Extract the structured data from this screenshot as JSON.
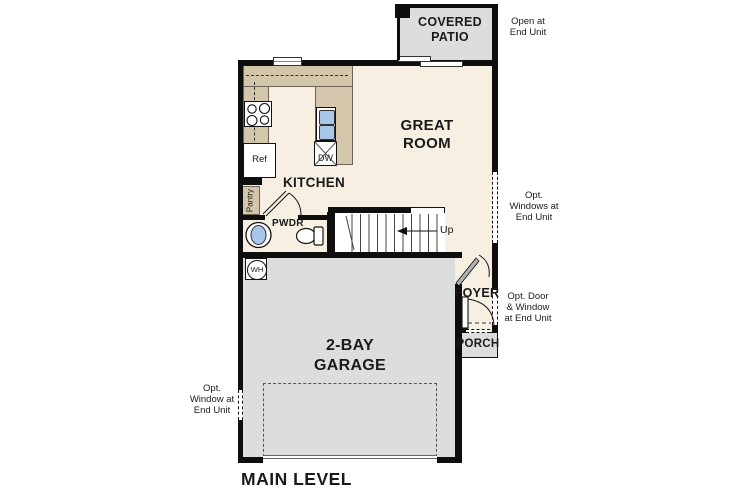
{
  "plan_title": "MAIN LEVEL",
  "rooms": {
    "covered_patio": "COVERED\nPATIO",
    "great_room": "GREAT\nROOM",
    "kitchen": "KITCHEN",
    "powder": "PWDR",
    "garage": "2-BAY\nGARAGE",
    "foyer": "FOYER",
    "porch": "PORCH"
  },
  "fixtures": {
    "refrigerator": "Ref",
    "dishwasher": "DW",
    "pantry": "Pantry",
    "water_heater": "WH",
    "stairs_direction": "Up"
  },
  "annotations": {
    "patio_open": "Open at\nEnd Unit",
    "opt_windows_right": "Opt.\nWindows at\nEnd Unit",
    "opt_door_window": "Opt. Door\n& Window\nat End Unit",
    "opt_window_left": "Opt.\nWindow at\nEnd Unit"
  },
  "colors": {
    "floor": "#f7efe2",
    "counter": "#d3c6ab",
    "concrete": "#dcdedd",
    "fixture": "#a9c7e9",
    "wall": "#0e0e0e",
    "ink": "#1a1a1a"
  }
}
